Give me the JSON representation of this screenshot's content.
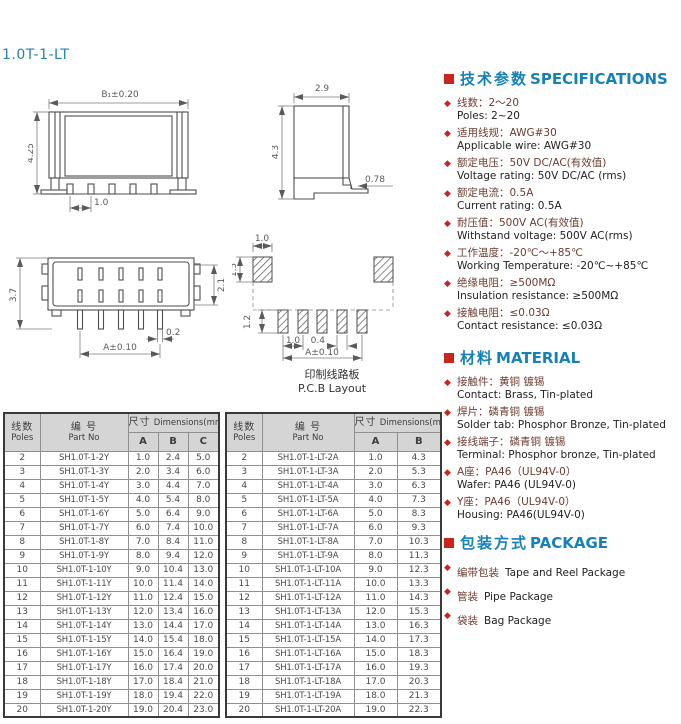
{
  "page": {
    "title": "1.0T-1-LT"
  },
  "colors": {
    "accent_blue": "#1581b8",
    "bullet_red": "#c9251c",
    "cn_text": "#6d3c30",
    "en_text": "#222222",
    "table_header_bg": "#d5d5d5"
  },
  "drawings": {
    "front_view": {
      "width_label": "B₁±0.20",
      "height_label": "4.25",
      "pitch_label": "1.0"
    },
    "side_view": {
      "width_label": "2.9",
      "height_label": "4.3",
      "foot_label": "0.78"
    },
    "top_view": {
      "height_label": "3.7",
      "cavity_label": "2.1",
      "pin_width_label": "0.2",
      "span_label": "A±0.10"
    },
    "pcb_layout": {
      "pad_width_label": "1.0",
      "pad_height_label": "1.5",
      "pin_height_label": "1.2",
      "pitch_label": "1.0",
      "pin_width_label": "0.4",
      "span_label": "A±0.10",
      "caption_cn": "印制线路板",
      "caption_en": "P.C.B Layout"
    }
  },
  "specifications": {
    "title_cn": "技术参数",
    "title_en": "SPECIFICATIONS",
    "items": [
      {
        "cn": "线数：2～20",
        "en": "Poles: 2~20"
      },
      {
        "cn": "适用线规：AWG#30",
        "en": "Applicable wire: AWG#30"
      },
      {
        "cn": "额定电压：50V DC/AC(有效值)",
        "en": "Voltage rating: 50V DC/AC (rms)"
      },
      {
        "cn": "额定电流：0.5A",
        "en": "Current rating: 0.5A"
      },
      {
        "cn": "耐压值：500V AC(有效值)",
        "en": "Withstand voltage: 500V AC(rms)"
      },
      {
        "cn": "工作温度：-20℃～+85℃",
        "en": "Working Temperature: -20℃~+85℃"
      },
      {
        "cn": "绝缘电阻：≥500MΩ",
        "en": "Insulation resistance: ≥500MΩ"
      },
      {
        "cn": "接触电阻：≤0.03Ω",
        "en": "Contact resistance: ≤0.03Ω"
      }
    ]
  },
  "material": {
    "title_cn": "材料",
    "title_en": "MATERIAL",
    "items": [
      {
        "cn": "接触件：黄铜 镀锡",
        "en": "Contact: Brass, Tin-plated"
      },
      {
        "cn": "焊片：磷青铜 镀锡",
        "en": "Solder tab: Phosphor Bronze, Tin-plated"
      },
      {
        "cn": "接线端子：磷青铜 镀锡",
        "en": "Terminal: Phosphor bronze, Tin-plated"
      },
      {
        "cn": "A座：PA46（UL94V-0）",
        "en": "Wafer: PA46 (UL94V-0)"
      },
      {
        "cn": "Y座：PA46（UL94V-0）",
        "en": "Housing: PA46(UL94V-0)"
      }
    ]
  },
  "package": {
    "title_cn": "包装方式",
    "title_en": "PACKAGE",
    "items": [
      {
        "cn": "编带包装",
        "en": "Tape and Reel Package"
      },
      {
        "cn": "管装",
        "en": "Pipe Package"
      },
      {
        "cn": "袋装",
        "en": "Bag Package"
      }
    ]
  },
  "tables": [
    {
      "header": {
        "poles_cn": "线数",
        "poles_en": "Poles",
        "part_cn": "编 号",
        "part_en": "Part No",
        "dim_cn": "尺寸",
        "dim_en": "Dimensions(mm)",
        "cols": [
          "A",
          "B",
          "C"
        ]
      },
      "rows": [
        [
          "2",
          "SH1.0T-1-2Y",
          "1.0",
          "2.4",
          "5.0"
        ],
        [
          "3",
          "SH1.0T-1-3Y",
          "2.0",
          "3.4",
          "6.0"
        ],
        [
          "4",
          "SH1.0T-1-4Y",
          "3.0",
          "4.4",
          "7.0"
        ],
        [
          "5",
          "SH1.0T-1-5Y",
          "4.0",
          "5.4",
          "8.0"
        ],
        [
          "6",
          "SH1.0T-1-6Y",
          "5.0",
          "6.4",
          "9.0"
        ],
        [
          "7",
          "SH1.0T-1-7Y",
          "6.0",
          "7.4",
          "10.0"
        ],
        [
          "8",
          "SH1.0T-1-8Y",
          "7.0",
          "8.4",
          "11.0"
        ],
        [
          "9",
          "SH1.0T-1-9Y",
          "8.0",
          "9.4",
          "12.0"
        ],
        [
          "10",
          "SH1.0T-1-10Y",
          "9.0",
          "10.4",
          "13.0"
        ],
        [
          "11",
          "SH1.0T-1-11Y",
          "10.0",
          "11.4",
          "14.0"
        ],
        [
          "12",
          "SH1.0T-1-12Y",
          "11.0",
          "12.4",
          "15.0"
        ],
        [
          "13",
          "SH1.0T-1-13Y",
          "12.0",
          "13.4",
          "16.0"
        ],
        [
          "14",
          "SH1.0T-1-14Y",
          "13.0",
          "14.4",
          "17.0"
        ],
        [
          "15",
          "SH1.0T-1-15Y",
          "14.0",
          "15.4",
          "18.0"
        ],
        [
          "16",
          "SH1.0T-1-16Y",
          "15.0",
          "16.4",
          "19.0"
        ],
        [
          "17",
          "SH1.0T-1-17Y",
          "16.0",
          "17.4",
          "20.0"
        ],
        [
          "18",
          "SH1.0T-1-18Y",
          "17.0",
          "18.4",
          "21.0"
        ],
        [
          "19",
          "SH1.0T-1-19Y",
          "18.0",
          "19.4",
          "22.0"
        ],
        [
          "20",
          "SH1.0T-1-20Y",
          "19.0",
          "20.4",
          "23.0"
        ]
      ]
    },
    {
      "header": {
        "poles_cn": "线数",
        "poles_en": "Poles",
        "part_cn": "编 号",
        "part_en": "Part No",
        "dim_cn": "尺寸",
        "dim_en": "Dimensions(mm)",
        "cols": [
          "A",
          "B"
        ]
      },
      "rows": [
        [
          "2",
          "SH1.0T-1-LT-2A",
          "1.0",
          "4.3"
        ],
        [
          "3",
          "SH1.0T-1-LT-3A",
          "2.0",
          "5.3"
        ],
        [
          "4",
          "SH1.0T-1-LT-4A",
          "3.0",
          "6.3"
        ],
        [
          "5",
          "SH1.0T-1-LT-5A",
          "4.0",
          "7.3"
        ],
        [
          "6",
          "SH1.0T-1-LT-6A",
          "5.0",
          "8.3"
        ],
        [
          "7",
          "SH1.0T-1-LT-7A",
          "6.0",
          "9.3"
        ],
        [
          "8",
          "SH1.0T-1-LT-8A",
          "7.0",
          "10.3"
        ],
        [
          "9",
          "SH1.0T-1-LT-9A",
          "8.0",
          "11.3"
        ],
        [
          "10",
          "SH1.0T-1-LT-10A",
          "9.0",
          "12.3"
        ],
        [
          "11",
          "SH1.0T-1-LT-11A",
          "10.0",
          "13.3"
        ],
        [
          "12",
          "SH1.0T-1-LT-12A",
          "11.0",
          "14.3"
        ],
        [
          "13",
          "SH1.0T-1-LT-13A",
          "12.0",
          "15.3"
        ],
        [
          "14",
          "SH1.0T-1-LT-14A",
          "13.0",
          "16.3"
        ],
        [
          "15",
          "SH1.0T-1-LT-15A",
          "14.0",
          "17.3"
        ],
        [
          "16",
          "SH1.0T-1-LT-16A",
          "15.0",
          "18.3"
        ],
        [
          "17",
          "SH1.0T-1-LT-17A",
          "16.0",
          "19.3"
        ],
        [
          "18",
          "SH1.0T-1-LT-18A",
          "17.0",
          "20.3"
        ],
        [
          "19",
          "SH1.0T-1-LT-19A",
          "18.0",
          "21.3"
        ],
        [
          "20",
          "SH1.0T-1-LT-20A",
          "19.0",
          "22.3"
        ]
      ]
    }
  ]
}
